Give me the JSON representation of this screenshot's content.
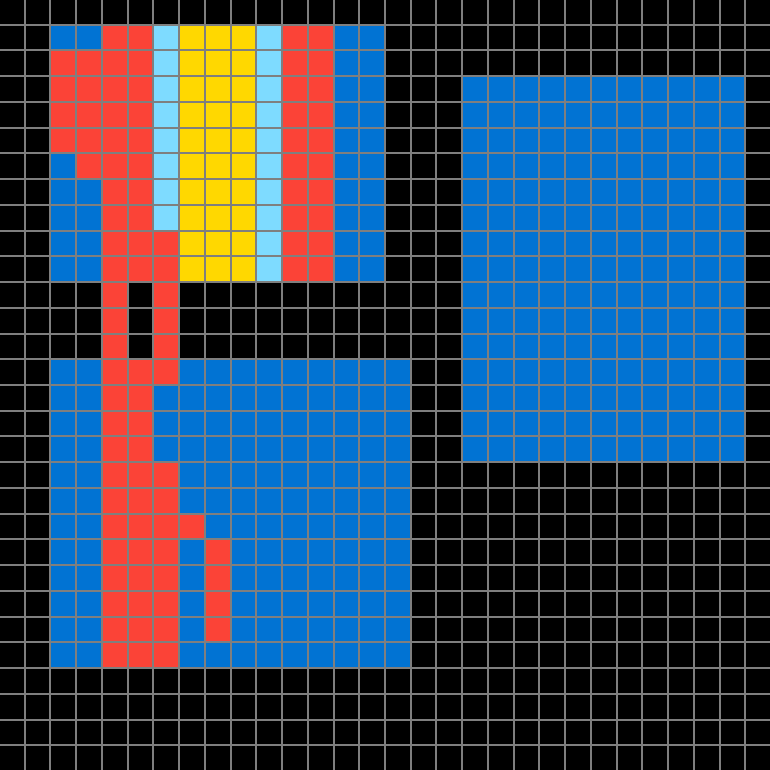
{
  "canvas": {
    "columns": 30,
    "rows_count": 30,
    "cell_pitch_px": 25.67,
    "grid_line_px": 2,
    "grid_line_color": "#7F7F7F",
    "background_color": "#000000",
    "palette": {
      ".": "#000000",
      "B": "#0173D3",
      "R": "#FB4337",
      "Y": "#FFD800",
      "A": "#7EDBFF"
    },
    "palette_names": {
      ".": "black-empty",
      "B": "blue",
      "R": "red",
      "Y": "yellow",
      "A": "light-blue"
    },
    "pixels": [
      "..............................",
      "..BBRRAYYYARRBB...............",
      "..RRRRAYYYARRBB...............",
      "..RRRRAYYYARRBB...BBBBBBBBBBB.",
      "..RRRRAYYYARRBB...BBBBBBBBBBB.",
      "..RRRRAYYYARRBB...BBBBBBBBBBB.",
      "..BRRRAYYYARRBB...BBBBBBBBBBB.",
      "..BBRRAYYYARRBB...BBBBBBBBBBB.",
      "..BBRRAYYYARRBB...BBBBBBBBBBB.",
      "..BBRRRYYYARRBB...BBBBBBBBBBB.",
      "..BBRRRYYYARRBB...BBBBBBBBBBB.",
      "....R.R...........BBBBBBBBBBB.",
      "....R.R...........BBBBBBBBBBB.",
      "....R.R...........BBBBBBBBBBB.",
      "..BBRRRBBBBBBBBB..BBBBBBBBBBB.",
      "..BBRRBBBBBBBBBB..BBBBBBBBBBB.",
      "..BBRRBBBBBBBBBB..BBBBBBBBBBB.",
      "..BBRRBBBBBBBBBB..BBBBBBBBBBB.",
      "..BBRRRBBBBBBBBB..............",
      "..BBRRRBBBBBBBBB..............",
      "..BBRRRRBBBBBBBB..............",
      "..BBRRRBRBBBBBBB..............",
      "..BBRRRBRBBBBBBB..............",
      "..BBRRRBRBBBBBBB..............",
      "..BBRRRBRBBBBBBB..............",
      "..BBRRRBBBBBBBBB..............",
      "..............................",
      "..............................",
      "..............................",
      ".............................."
    ]
  }
}
